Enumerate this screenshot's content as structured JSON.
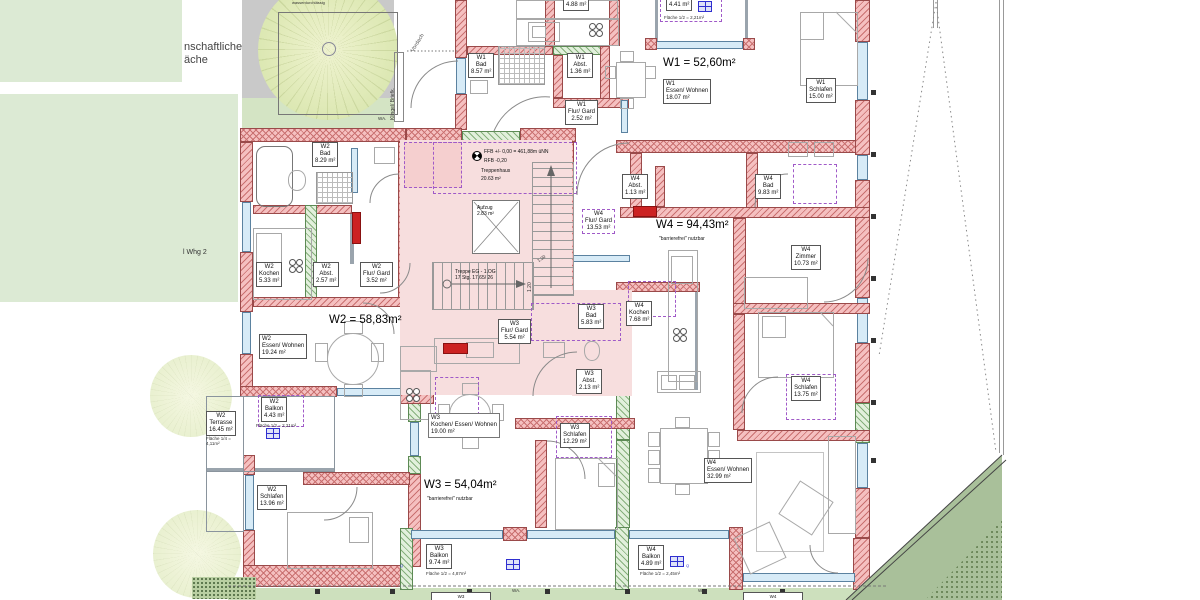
{
  "site": {
    "area_label_l1": "nschaftliche",
    "area_label_l2": "äche",
    "garden_label": "l Whg 2",
    "permeable_label": "wasserdurchlässig",
    "canopy_label": "Vordach",
    "bell_label": "Klingel/ Briefk.",
    "wa_label": "WA."
  },
  "stairwell": {
    "ffb": "FFB +/- 0,00 = 461,88m üNN",
    "rfb": "RFB -0,20",
    "name": "Treppenhaus",
    "area": "20.63 m²",
    "lift": "Aufzug",
    "lift_area": "2.83 m²",
    "run": "Treppe EG - 1.OG",
    "steps": "17 Stg. 17,65/ 26",
    "dim": "1.20"
  },
  "apartments": [
    {
      "id": "W1",
      "total": "W1 = 52,60m²",
      "rooms": [
        {
          "name": "Bad",
          "area": "8.57 m²"
        },
        {
          "name": "Abst.",
          "area": "1.36 m²"
        },
        {
          "name": "Flur/ Gard",
          "area": "2.52 m²"
        },
        {
          "name": "Kochen",
          "area": "4.88 m²"
        },
        {
          "name": "Essen/ Wohnen",
          "area": "18.07 m²"
        },
        {
          "name": "Schlafen",
          "area": "15.00 m²"
        },
        {
          "name": "Balkon",
          "area": "4.41 m²",
          "extra": "Fläche 1/2 = 2,21m²"
        }
      ]
    },
    {
      "id": "W2",
      "total": "W2 = 58,83m²",
      "rooms": [
        {
          "name": "Bad",
          "area": "8.29 m²"
        },
        {
          "name": "Kochen",
          "area": "5.33 m²"
        },
        {
          "name": "Abst.",
          "area": "2.57 m²"
        },
        {
          "name": "Flur/ Gard",
          "area": "3.52 m²"
        },
        {
          "name": "Essen/ Wohnen",
          "area": "19.24 m²"
        },
        {
          "name": "Balkon",
          "area": "4.43 m²",
          "extra": "Fläche 1/2 = 2,21m²"
        },
        {
          "name": "Terrasse",
          "area": "16.45 m²",
          "extra": "Fläche 1/4 = 4,11m²"
        },
        {
          "name": "Schlafen",
          "area": "13.96 m²"
        }
      ]
    },
    {
      "id": "W3",
      "total": "W3 = 54,04m²",
      "note": "\"barrierefrei\" nutzbar",
      "rooms": [
        {
          "name": "Flur/ Gard",
          "area": "5.54 m²"
        },
        {
          "name": "Bad",
          "area": "5.83 m²"
        },
        {
          "name": "Abst.",
          "area": "2.13 m²"
        },
        {
          "name": "Kochen/ Essen/ Wohnen",
          "area": "19.00 m²"
        },
        {
          "name": "Schlafen",
          "area": "12.29 m²"
        },
        {
          "name": "Balkon",
          "area": "9.74 m²",
          "extra": "Fläche 1/2 = 4,87m²"
        }
      ]
    },
    {
      "id": "W4",
      "total": "W4 = 94,43m²",
      "note": "\"barrierefrei\" nutzbar",
      "rooms": [
        {
          "name": "Abst.",
          "area": "1.13 m²"
        },
        {
          "name": "Flur/ Gard",
          "area": "13.53 m²"
        },
        {
          "name": "Bad",
          "area": "9.83 m²"
        },
        {
          "name": "Zimmer",
          "area": "10.73 m²"
        },
        {
          "name": "Kochen",
          "area": "7.68 m²"
        },
        {
          "name": "Schlafen",
          "area": "13.75 m²"
        },
        {
          "name": "Essen/ Wohnen",
          "area": "32.99 m²"
        },
        {
          "name": "Balkon",
          "area": "4.89 m²",
          "extra": "Fläche 1/2 = 2,45m²"
        }
      ]
    }
  ],
  "bottom_tags": {
    "w3": "W3",
    "w4": "W4"
  },
  "misc": {
    "drain_mark": "Q"
  },
  "colors": {
    "wall_red": "#f5c0c0",
    "wall_hatch": "#c97070",
    "wall_green": "#e2f0dc",
    "window": "#d7ebf7",
    "stair_pink": "#f7dede",
    "site_green": "#dcead4",
    "strip_green": "#cde0bd",
    "dark_green": "#a9c09a",
    "courtyard_gray": "#c9c9c9",
    "dashed_violet": "#a05ac8",
    "icon_blue": "#2f2fd0"
  }
}
